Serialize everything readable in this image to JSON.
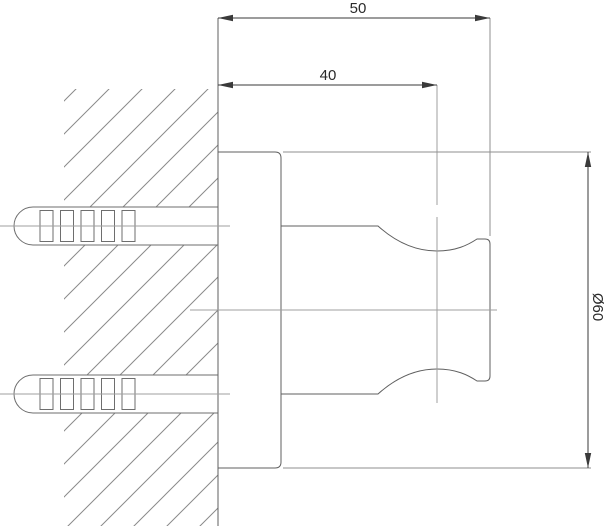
{
  "drawing": {
    "dimension_labels": {
      "overall_depth": "50",
      "body_depth": "40",
      "flange_diameter": "Ø60"
    },
    "colors": {
      "background": "#ffffff",
      "object_line": "#5f5f5f",
      "anchor_line": "#6e6e6e",
      "dimension_line": "#3a3a3a",
      "extension_line": "#8f8f8f",
      "centerline": "#9f9f9f",
      "hatch": "#8a8a8a",
      "text": "#2a2a2a"
    }
  }
}
